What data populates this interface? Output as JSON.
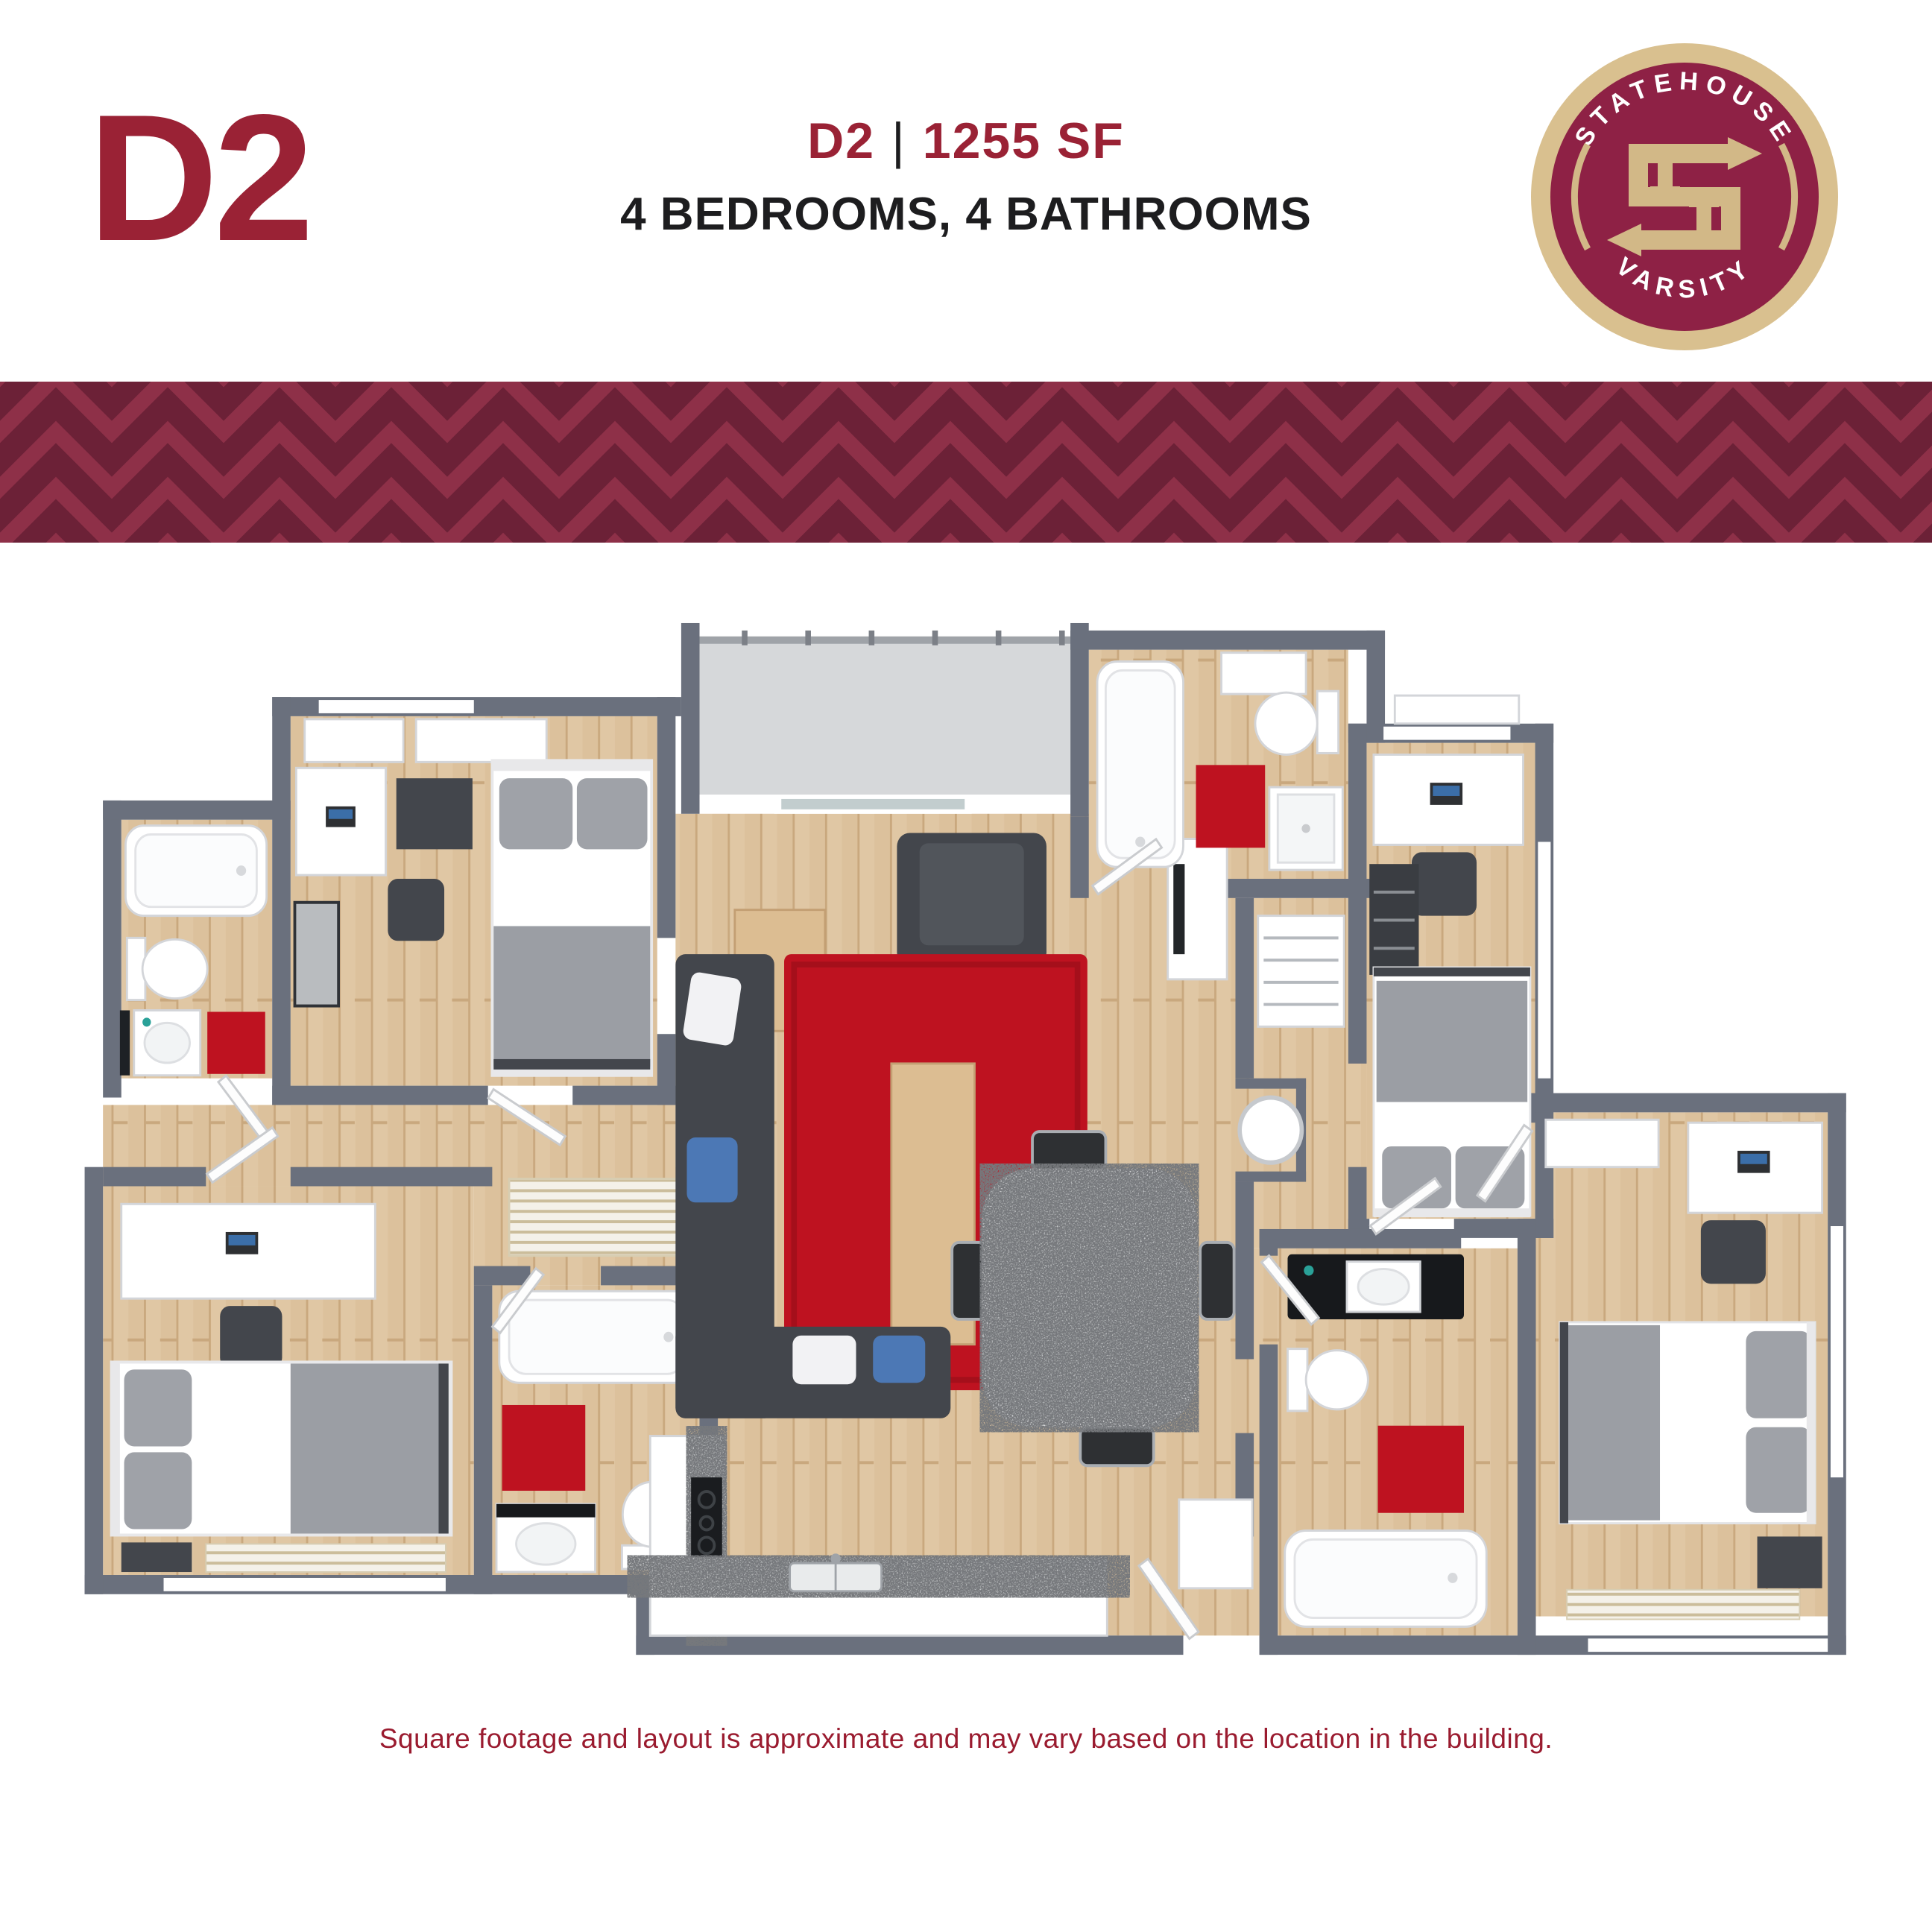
{
  "header": {
    "unit_code": "D2",
    "plan_code": "D2",
    "divider": "|",
    "square_footage": "1255 SF",
    "subtitle": "4 BEDROOMS, 4 BATHROOMS"
  },
  "logo": {
    "arc_top": "STATEHOUSE",
    "arc_bottom": "VARSITY",
    "monogram": "SH"
  },
  "footer": {
    "disclaimer": "Square footage and layout is approximate and may vary based on the location in the building."
  },
  "colors": {
    "brand_maroon": "#9A2235",
    "logo_maroon": "#8E2145",
    "logo_gold": "#D9C08F",
    "chevron_light": "#8E3048",
    "chevron_dark": "#6C2137",
    "disclaimer_text": "#9A1B2F",
    "wall_gray": "#6A707D",
    "floor_wood": "#DFC5A1",
    "balcony_gray": "#D6D8DA",
    "rug_red": "#BE1220",
    "granite_gray": "#C9CBCD"
  },
  "floorplan": {
    "bedrooms": 4,
    "bathrooms": 4,
    "rooms": [
      {
        "id": "bedroom-1",
        "furniture": [
          "bed",
          "desk",
          "office-chair",
          "nightstand",
          "media-cabinet",
          "closets"
        ]
      },
      {
        "id": "bathroom-1",
        "furniture": [
          "bathtub",
          "toilet",
          "sink",
          "red-rug",
          "shelf"
        ]
      },
      {
        "id": "bedroom-2",
        "furniture": [
          "bed",
          "desk",
          "office-chair",
          "dresser",
          "closet"
        ]
      },
      {
        "id": "bathroom-2",
        "furniture": [
          "bathtub",
          "toilet",
          "shower",
          "sink",
          "red-rug"
        ]
      },
      {
        "id": "bedroom-3",
        "furniture": [
          "bed",
          "desk",
          "office-chair",
          "nightstand",
          "radiator",
          "louvered-closet"
        ]
      },
      {
        "id": "bathroom-3",
        "furniture": [
          "bathtub",
          "toilet",
          "sink",
          "red-rug"
        ]
      },
      {
        "id": "bedroom-4",
        "furniture": [
          "bed",
          "desk",
          "office-chair",
          "nightstand",
          "radiator",
          "closet"
        ]
      },
      {
        "id": "bathroom-4",
        "furniture": [
          "bathtub",
          "toilet",
          "vanity-sink",
          "red-rug"
        ]
      },
      {
        "id": "living-room",
        "furniture": [
          "sectional-sofa",
          "armchair",
          "red-shag-rug",
          "coffee-table",
          "side-table",
          "tv-console"
        ]
      },
      {
        "id": "dining-area",
        "furniture": [
          "granite-table",
          "chair",
          "chair",
          "chair",
          "chair"
        ]
      },
      {
        "id": "kitchen",
        "furniture": [
          "l-shaped-counter",
          "cooktop",
          "double-sink"
        ]
      },
      {
        "id": "balcony",
        "furniture": [
          "railing",
          "sliding-glass-door"
        ]
      },
      {
        "id": "hallway",
        "furniture": [
          "closets",
          "water-heater",
          "entry-door"
        ]
      }
    ]
  }
}
